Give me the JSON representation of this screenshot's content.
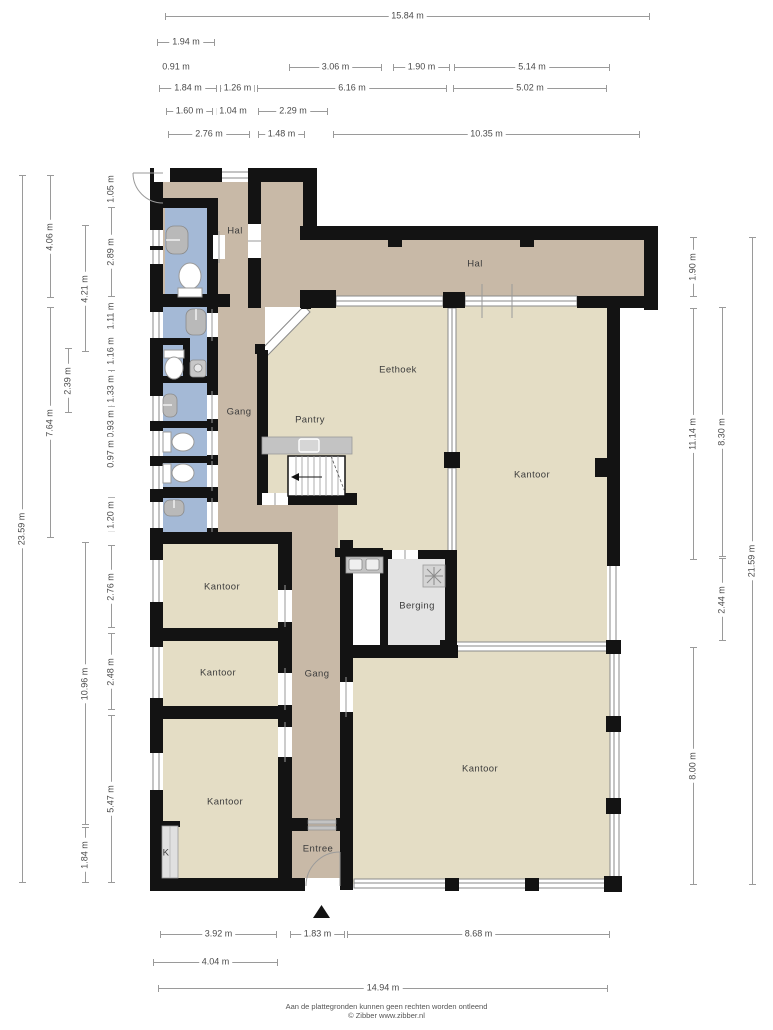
{
  "footer": {
    "line1": "Aan de plattegronden kunnen geen rechten worden ontleend",
    "line2": "© Zibber www.zibber.nl"
  },
  "colors": {
    "wall": "#131313",
    "hall_floor": "#c8b9a7",
    "office_floor": "#e4ddc5",
    "sanitary_floor": "#a4b9d6",
    "storage_floor": "#e3e3e3",
    "counter": "#c3c3c3",
    "dimension_line": "#9a9a9a",
    "dimension_text": "#4b4b4b"
  },
  "rooms": [
    {
      "label": "Hal",
      "x": 235,
      "y": 231
    },
    {
      "label": "Hal",
      "x": 475,
      "y": 264
    },
    {
      "label": "Eethoek",
      "x": 398,
      "y": 370
    },
    {
      "label": "Gang",
      "x": 239,
      "y": 412
    },
    {
      "label": "Pantry",
      "x": 310,
      "y": 420
    },
    {
      "label": "Kantoor",
      "x": 532,
      "y": 475
    },
    {
      "label": "Kantoor",
      "x": 222,
      "y": 587
    },
    {
      "label": "Berging",
      "x": 417,
      "y": 606
    },
    {
      "label": "Kantoor",
      "x": 218,
      "y": 673
    },
    {
      "label": "Gang",
      "x": 317,
      "y": 674
    },
    {
      "label": "Kantoor",
      "x": 480,
      "y": 769
    },
    {
      "label": "Kantoor",
      "x": 225,
      "y": 802
    },
    {
      "label": "Entree",
      "x": 318,
      "y": 849
    },
    {
      "label": "K",
      "x": 166,
      "y": 853
    }
  ],
  "dimensions": [
    {
      "label": "15.84 m",
      "x": 165,
      "y": 16,
      "len": 485,
      "o": "h"
    },
    {
      "label": "1.94 m",
      "x": 157,
      "y": 42,
      "len": 58,
      "o": "h"
    },
    {
      "label": "0.91 m",
      "x": 155,
      "y": 67,
      "len": 42,
      "o": "h",
      "line": false
    },
    {
      "label": "3.06 m",
      "x": 289,
      "y": 67,
      "len": 93,
      "o": "h"
    },
    {
      "label": "1.90 m",
      "x": 393,
      "y": 67,
      "len": 57,
      "o": "h"
    },
    {
      "label": "5.14 m",
      "x": 454,
      "y": 67,
      "len": 156,
      "o": "h"
    },
    {
      "label": "1.84 m",
      "x": 159,
      "y": 88,
      "len": 58,
      "o": "h"
    },
    {
      "label": "1.26 m",
      "x": 220,
      "y": 88,
      "len": 35,
      "o": "h"
    },
    {
      "label": "6.16 m",
      "x": 257,
      "y": 88,
      "len": 190,
      "o": "h"
    },
    {
      "label": "5.02 m",
      "x": 453,
      "y": 88,
      "len": 154,
      "o": "h"
    },
    {
      "label": "1.60 m",
      "x": 166,
      "y": 111,
      "len": 47,
      "o": "h"
    },
    {
      "label": "1.04 m",
      "x": 216,
      "y": 111,
      "len": 34,
      "o": "h"
    },
    {
      "label": "2.29 m",
      "x": 258,
      "y": 111,
      "len": 70,
      "o": "h"
    },
    {
      "label": "2.76 m",
      "x": 168,
      "y": 134,
      "len": 82,
      "o": "h"
    },
    {
      "label": "1.48 m",
      "x": 258,
      "y": 134,
      "len": 47,
      "o": "h"
    },
    {
      "label": "10.35 m",
      "x": 333,
      "y": 134,
      "len": 307,
      "o": "h"
    },
    {
      "label": "3.92 m",
      "x": 160,
      "y": 934,
      "len": 117,
      "o": "h"
    },
    {
      "label": "1.83 m",
      "x": 290,
      "y": 934,
      "len": 55,
      "o": "h"
    },
    {
      "label": "8.68 m",
      "x": 347,
      "y": 934,
      "len": 263,
      "o": "h"
    },
    {
      "label": "4.04 m",
      "x": 153,
      "y": 962,
      "len": 125,
      "o": "h"
    },
    {
      "label": "14.94 m",
      "x": 158,
      "y": 988,
      "len": 450,
      "o": "h"
    },
    {
      "label": "23.59 m",
      "x": 22,
      "y": 175,
      "len": 708,
      "o": "v"
    },
    {
      "label": "4.06 m",
      "x": 50,
      "y": 175,
      "len": 123,
      "o": "v"
    },
    {
      "label": "7.64 m",
      "x": 50,
      "y": 307,
      "len": 231,
      "o": "v"
    },
    {
      "label": "2.39 m",
      "x": 68,
      "y": 348,
      "len": 65,
      "o": "v"
    },
    {
      "label": "4.21 m",
      "x": 85,
      "y": 225,
      "len": 127,
      "o": "v"
    },
    {
      "label": "10.96 m",
      "x": 85,
      "y": 542,
      "len": 283,
      "o": "v"
    },
    {
      "label": "1.84 m",
      "x": 85,
      "y": 827,
      "len": 56,
      "o": "v"
    },
    {
      "label": "1.05 m",
      "x": 111,
      "y": 175,
      "len": 28,
      "o": "v"
    },
    {
      "label": "2.89 m",
      "x": 111,
      "y": 207,
      "len": 90,
      "o": "v"
    },
    {
      "label": "1.11 m",
      "x": 111,
      "y": 300,
      "len": 32,
      "o": "v"
    },
    {
      "label": "1.16 m",
      "x": 111,
      "y": 335,
      "len": 32,
      "o": "v"
    },
    {
      "label": "1.33 m",
      "x": 111,
      "y": 370,
      "len": 37,
      "o": "v"
    },
    {
      "label": "0.93 m",
      "x": 111,
      "y": 410,
      "len": 27,
      "o": "v"
    },
    {
      "label": "0.97 m",
      "x": 111,
      "y": 440,
      "len": 28,
      "o": "v"
    },
    {
      "label": "1.20 m",
      "x": 111,
      "y": 497,
      "len": 35,
      "o": "v"
    },
    {
      "label": "2.76 m",
      "x": 111,
      "y": 545,
      "len": 83,
      "o": "v"
    },
    {
      "label": "2.48 m",
      "x": 111,
      "y": 633,
      "len": 77,
      "o": "v"
    },
    {
      "label": "5.47 m",
      "x": 111,
      "y": 715,
      "len": 168,
      "o": "v"
    },
    {
      "label": "1.90 m",
      "x": 693,
      "y": 237,
      "len": 60,
      "o": "v"
    },
    {
      "label": "11.14 m",
      "x": 693,
      "y": 308,
      "len": 252,
      "o": "v"
    },
    {
      "label": "8.00 m",
      "x": 693,
      "y": 647,
      "len": 238,
      "o": "v"
    },
    {
      "label": "8.30 m",
      "x": 722,
      "y": 307,
      "len": 250,
      "o": "v"
    },
    {
      "label": "2.44 m",
      "x": 722,
      "y": 558,
      "len": 83,
      "o": "v"
    },
    {
      "label": "21.59 m",
      "x": 752,
      "y": 237,
      "len": 648,
      "o": "v"
    }
  ]
}
